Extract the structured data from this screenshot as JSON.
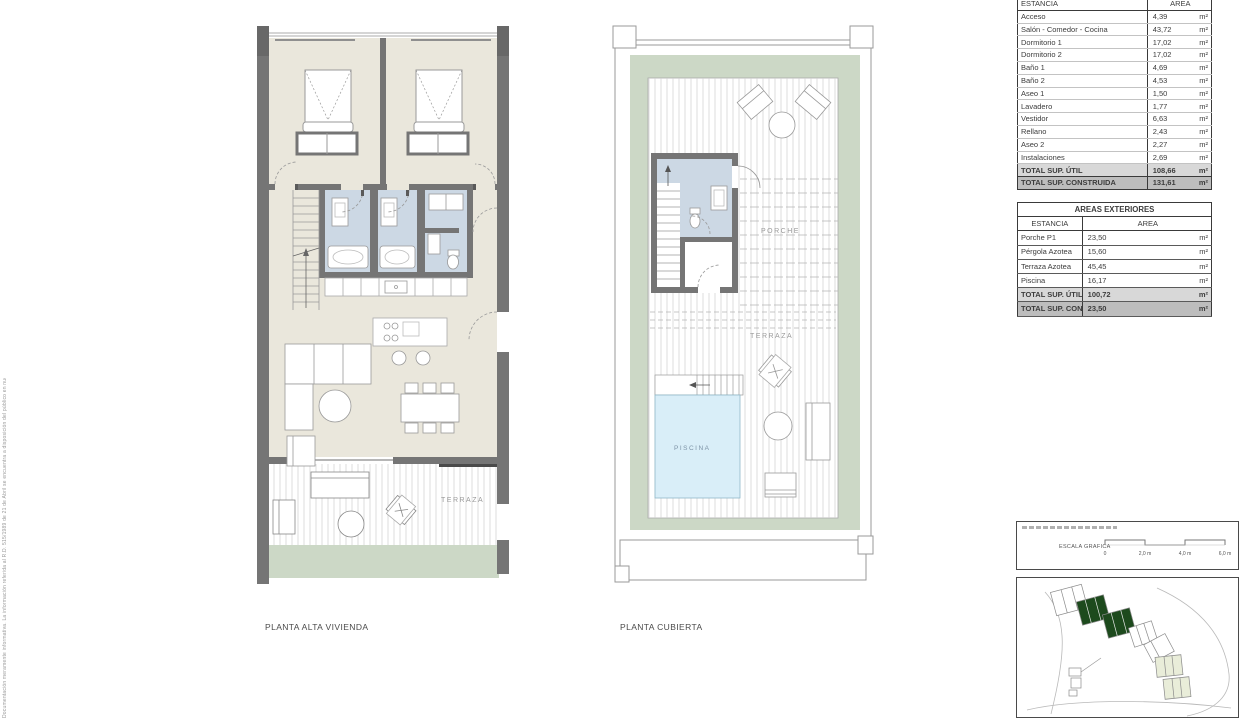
{
  "sheet": {
    "side_note": "Documentación meramente informativa. La información referida al R.D. 515/1989 de 21 de Abril se encuentra a disposición del público en nuestras oficinas. No se considera incluido en la venta del inmueble el mobiliario.",
    "colors": {
      "wall_gray": "#757575",
      "floor_beige": "#eae7dc",
      "wet_room_blue": "#ccd8e4",
      "pool_blue": "#d9eef8",
      "planter_green": "#ccd8c6",
      "site_building_green": "#1d4a1d",
      "table_total_util_bg": "#d8d8d8",
      "table_total_cons_bg": "#bdbdbd"
    }
  },
  "plans": {
    "alta": {
      "caption": "PLANTA ALTA VIVIENDA",
      "labels": {
        "terraza": "TERRAZA"
      }
    },
    "cubierta": {
      "caption": "PLANTA CUBIERTA",
      "labels": {
        "porche": "PORCHE",
        "terraza": "TERRAZA",
        "piscina": "PISCINA"
      }
    }
  },
  "tables": {
    "interior": {
      "headers": {
        "estancia": "ESTANCIA",
        "area": "AREA"
      },
      "rows": [
        {
          "name": "Acceso",
          "area": "4,39",
          "unit": "m²"
        },
        {
          "name": "Salón - Comedor - Cocina",
          "area": "43,72",
          "unit": "m²"
        },
        {
          "name": "Dormitorio 1",
          "area": "17,02",
          "unit": "m²"
        },
        {
          "name": "Dormitorio 2",
          "area": "17,02",
          "unit": "m²"
        },
        {
          "name": "Baño 1",
          "area": "4,69",
          "unit": "m²"
        },
        {
          "name": "Baño 2",
          "area": "4,53",
          "unit": "m²"
        },
        {
          "name": "Aseo 1",
          "area": "1,50",
          "unit": "m²"
        },
        {
          "name": "Lavadero",
          "area": "1,77",
          "unit": "m²"
        },
        {
          "name": "Vestidor",
          "area": "6,63",
          "unit": "m²"
        },
        {
          "name": "Rellano",
          "area": "2,43",
          "unit": "m²"
        },
        {
          "name": "Aseo 2",
          "area": "2,27",
          "unit": "m²"
        },
        {
          "name": "Instalaciones",
          "area": "2,69",
          "unit": "m²"
        }
      ],
      "total_util": {
        "name": "TOTAL SUP. ÚTIL",
        "area": "108,66",
        "unit": "m²"
      },
      "total_cons": {
        "name": "TOTAL SUP. CONSTRUIDA",
        "area": "131,61",
        "unit": "m²"
      }
    },
    "exterior": {
      "title": "AREAS EXTERIORES",
      "headers": {
        "estancia": "ESTANCIA",
        "area": "AREA"
      },
      "rows": [
        {
          "name": "Porche P1",
          "area": "23,50",
          "unit": "m²"
        },
        {
          "name": "Pérgola Azotea",
          "area": "15,60",
          "unit": "m²"
        },
        {
          "name": "Terraza Azotea",
          "area": "45,45",
          "unit": "m²"
        },
        {
          "name": "Piscina",
          "area": "16,17",
          "unit": "m²"
        }
      ],
      "total_util": {
        "name": "TOTAL SUP. ÚTIL",
        "area": "100,72",
        "unit": "m²"
      },
      "total_cons": {
        "name": "TOTAL SUP. CONSTRUIDA",
        "area": "23,50",
        "unit": "m²"
      }
    }
  },
  "scale": {
    "label": "ESCALA GRAFICA",
    "ticks": [
      "0",
      "2,0 m",
      "4,0 m",
      "6,0 m"
    ]
  }
}
